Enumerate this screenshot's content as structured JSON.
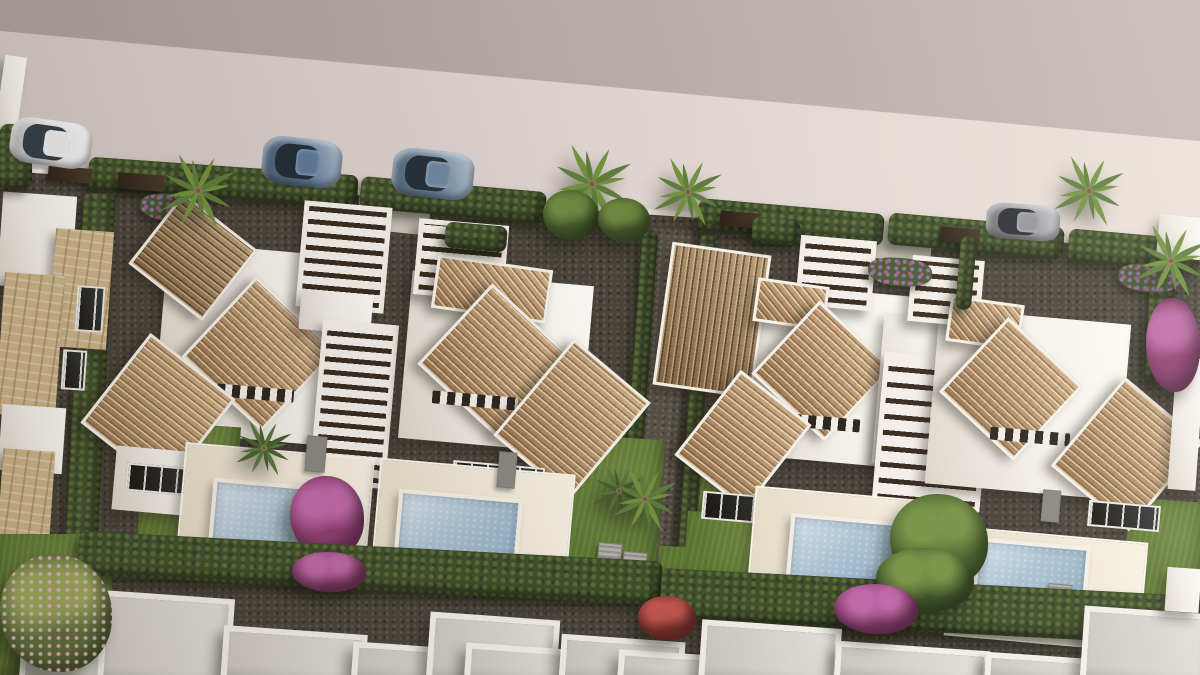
{
  "meta": {
    "scene_type": "3D aerial architectural rendering of a residential villa development",
    "view": "top-down bird's-eye, street with parked cars at top, two blocks of twin villas with terracotta roofs, pergolas, lawns and private pools, hedge boundaries, second row of white flat roofs at bottom"
  },
  "palette": {
    "road": "#d8cdc9",
    "upper_wall": "#b2a7a4",
    "white_walls": "#f2eee8",
    "roof_tile": "#bd9466",
    "roof_tile_dark": "#9b7a50",
    "pergola_slat": "#382c20",
    "hedge": "#42502c",
    "lawn": "#5e7833",
    "gravel": "#4a443c",
    "pool_water": "#abc2d3",
    "terrace": "#ece3d2",
    "stone": "#ccb488",
    "bougainvillea": "#8d3f72",
    "car_blue": "#5f7b99",
    "car_white": "#ebebec",
    "car_gray": "#94939a"
  },
  "objects": [
    {
      "n": "upper-wall-band",
      "t": "flat",
      "f": "linear-gradient(90deg,#aba09e,#c2b7b4)",
      "c": "polygon(0% 0%,100% 0%,100% 21%,0% 4.6%)"
    },
    {
      "n": "road",
      "t": "flat",
      "f": "linear-gradient(90deg,#d3c8c4,#eae0db)",
      "c": "polygon(0% 4.6%,100% 20.9%,100% 37.6%,0% 25.3%)"
    },
    {
      "n": "curb-line",
      "t": "flat",
      "f": "#f1e9e3",
      "c": "polygon(0% 24.7%,100% 36.3%,100% 37.6%,0% 25.6%)"
    },
    {
      "n": "ground-gravel",
      "t": "gravel",
      "c": "polygon(0% 25.3%,100% 37.3%,100% 100%,0% 100%)"
    },
    {
      "n": "driveway-left",
      "t": "flat",
      "x": 358,
      "y": 194,
      "w": 72,
      "h": 38,
      "r": 6,
      "f": "#c8c0b7"
    },
    {
      "n": "driveway-right",
      "t": "flat",
      "x": 858,
      "y": 222,
      "w": 74,
      "h": 38,
      "r": 6,
      "f": "#c8c0b7"
    },
    {
      "n": "center-path",
      "t": "gravel2",
      "x": 640,
      "y": 228,
      "w": 46,
      "h": 370,
      "r": 4
    },
    {
      "n": "front-hedge-1",
      "t": "hedge",
      "x": 88,
      "y": 166,
      "w": 270,
      "h": 32,
      "r": 4
    },
    {
      "n": "front-hedge-2",
      "t": "hedge",
      "x": 360,
      "y": 184,
      "w": 186,
      "h": 32,
      "r": 5
    },
    {
      "n": "front-hedge-3",
      "t": "hedge",
      "x": 698,
      "y": 206,
      "w": 186,
      "h": 32,
      "r": 5
    },
    {
      "n": "front-hedge-4",
      "t": "hedge",
      "x": 888,
      "y": 220,
      "w": 176,
      "h": 32,
      "r": 5
    },
    {
      "n": "front-hedge-5",
      "t": "hedge",
      "x": 1068,
      "y": 234,
      "w": 132,
      "h": 32,
      "r": 5
    },
    {
      "n": "gate-1",
      "t": "gate",
      "x": 48,
      "y": 167,
      "w": 44,
      "h": 15,
      "r": 5
    },
    {
      "n": "gate-2",
      "t": "gate",
      "x": 118,
      "y": 174,
      "w": 46,
      "h": 16,
      "r": 5
    },
    {
      "n": "gate-3",
      "t": "gate",
      "x": 720,
      "y": 212,
      "w": 40,
      "h": 15,
      "r": 5
    },
    {
      "n": "gate-4",
      "t": "gate",
      "x": 940,
      "y": 228,
      "w": 40,
      "h": 15,
      "r": 5
    },
    {
      "n": "left-boundary-hedge",
      "t": "hedge",
      "x": 74,
      "y": 193,
      "w": 32,
      "h": 374,
      "r": 3
    },
    {
      "n": "center-hedge-west",
      "t": "hedge",
      "x": 630,
      "y": 230,
      "w": 16,
      "h": 356,
      "r": 4
    },
    {
      "n": "center-hedge-east",
      "t": "hedge",
      "x": 688,
      "y": 234,
      "w": 16,
      "h": 356,
      "r": 4
    },
    {
      "n": "right-boundary-hedge",
      "t": "hedge",
      "x": 1148,
      "y": 250,
      "w": 26,
      "h": 132,
      "r": 3
    },
    {
      "n": "lawn-strip-right",
      "t": "lawn",
      "x": 658,
      "y": 554,
      "w": 320,
      "h": 38,
      "r": 3
    },
    {
      "n": "neighbor-left-roof",
      "t": "white",
      "x": 0,
      "y": 194,
      "w": 74,
      "h": 94,
      "r": 4
    },
    {
      "n": "neighbor-left-stone-a",
      "t": "stone",
      "x": 52,
      "y": 230,
      "w": 58,
      "h": 118,
      "r": 4
    },
    {
      "n": "neighbor-left-window-1",
      "t": "window",
      "x": 76,
      "y": 286,
      "w": 24,
      "h": 42,
      "r": 4
    },
    {
      "n": "neighbor-left-window-2",
      "t": "window",
      "x": 62,
      "y": 350,
      "w": 20,
      "h": 36,
      "r": 4
    },
    {
      "n": "neighbor-left-stone-b",
      "t": "stone",
      "x": 0,
      "y": 274,
      "w": 60,
      "h": 142,
      "r": 4
    },
    {
      "n": "neighbor-left-wall",
      "t": "white",
      "x": 0,
      "y": 406,
      "w": 64,
      "h": 66,
      "r": 4
    },
    {
      "n": "neighbor-left-stone-c",
      "t": "stone",
      "x": 0,
      "y": 450,
      "w": 52,
      "h": 98,
      "r": 4
    },
    {
      "n": "corner-building",
      "t": "white",
      "x": 0,
      "y": 56,
      "w": 22,
      "h": 74,
      "r": 8
    },
    {
      "n": "corner-hedge",
      "t": "hedge",
      "x": 0,
      "y": 124,
      "w": 32,
      "h": 64
    },
    {
      "n": "planter-flowers-left",
      "t": "flower",
      "x": 140,
      "y": 194,
      "w": 72,
      "h": 28,
      "r": 4
    },
    {
      "n": "villaA-white-main",
      "t": "white",
      "x": 160,
      "y": 250,
      "w": 205,
      "h": 190,
      "r": 5
    },
    {
      "n": "villaA-lawn",
      "t": "lawn",
      "x": 140,
      "y": 424,
      "w": 96,
      "h": 146,
      "r": 4
    },
    {
      "n": "villaA-entry-roof",
      "t": "roof-dark",
      "x": 146,
      "y": 212,
      "w": 88,
      "h": 84,
      "r": 38,
      "a": 0
    },
    {
      "n": "villaA-roof-main",
      "t": "roof",
      "x": 204,
      "y": 299,
      "w": 104,
      "h": 104,
      "r": 43,
      "a": 0
    },
    {
      "n": "villaA-vent-row",
      "t": "vent",
      "x": 202,
      "y": 386,
      "w": 92,
      "h": 13,
      "r": 5
    },
    {
      "n": "villaA-roof-low",
      "t": "roof",
      "x": 104,
      "y": 354,
      "w": 102,
      "h": 108,
      "r": 38,
      "a": 0
    },
    {
      "n": "villaA-wall-low",
      "t": "white",
      "x": 114,
      "y": 450,
      "w": 106,
      "h": 64,
      "r": 5
    },
    {
      "n": "villaA-window-band",
      "t": "window",
      "x": 126,
      "y": 466,
      "w": 76,
      "h": 24,
      "r": 5
    },
    {
      "n": "villaA-street-pergola",
      "t": "pergola",
      "x": 300,
      "y": 204,
      "w": 78,
      "h": 96,
      "r": 5,
      "a": 0
    },
    {
      "n": "villaA-walkway",
      "t": "white",
      "x": 300,
      "y": 292,
      "w": 72,
      "h": 40,
      "r": 5
    },
    {
      "n": "villaA-mid-pergola",
      "t": "pergola",
      "x": 316,
      "y": 322,
      "w": 66,
      "h": 154,
      "r": 5,
      "a": 0
    },
    {
      "n": "villaA-terrace",
      "t": "terrace",
      "x": 180,
      "y": 450,
      "w": 186,
      "h": 120,
      "r": 5
    },
    {
      "n": "villaA-pool",
      "t": "pool",
      "x": 210,
      "y": 484,
      "w": 140,
      "h": 74,
      "r": 5
    },
    {
      "n": "villaA-grill",
      "t": "ac",
      "x": 306,
      "y": 436,
      "w": 18,
      "h": 34,
      "r": 5,
      "f": "#8b8883"
    },
    {
      "n": "villaA-garden-palm",
      "t": "palm",
      "x": 228,
      "y": 412,
      "w": 72,
      "h": 72,
      "c1": "#47612f",
      "c2": "#5a7740"
    },
    {
      "n": "villaA-bougainvillea",
      "t": "tree",
      "x": 290,
      "y": 476,
      "w": 74,
      "h": 82,
      "c1": "#c06aa8",
      "c2": "#8d3f72"
    },
    {
      "n": "villaB-white-main",
      "t": "white",
      "x": 405,
      "y": 278,
      "w": 182,
      "h": 168,
      "r": 5
    },
    {
      "n": "villaB-lawn",
      "t": "lawn",
      "x": 540,
      "y": 436,
      "w": 120,
      "h": 148,
      "r": 4
    },
    {
      "n": "villaB-street-pergola",
      "t": "pergola",
      "x": 416,
      "y": 222,
      "w": 80,
      "h": 66,
      "r": 5,
      "a": 0
    },
    {
      "n": "villaB-roof-strip",
      "t": "roof",
      "x": 434,
      "y": 262,
      "w": 110,
      "h": 48,
      "r": 8,
      "a": 43
    },
    {
      "n": "villaB-roof-main",
      "t": "roof",
      "x": 440,
      "y": 306,
      "w": 104,
      "h": 104,
      "r": 43,
      "a": 0
    },
    {
      "n": "villaB-vent-row",
      "t": "vent",
      "x": 432,
      "y": 394,
      "w": 86,
      "h": 13,
      "r": 5
    },
    {
      "n": "villaB-roof-right",
      "t": "roof",
      "x": 522,
      "y": 356,
      "w": 94,
      "h": 120,
      "r": 40,
      "a": 0
    },
    {
      "n": "villaB-window-band",
      "t": "window",
      "x": 452,
      "y": 464,
      "w": 88,
      "h": 26,
      "r": 5
    },
    {
      "n": "villaB-terrace",
      "t": "terrace",
      "x": 375,
      "y": 466,
      "w": 192,
      "h": 114,
      "r": 5
    },
    {
      "n": "villaB-pool",
      "t": "pool",
      "x": 396,
      "y": 494,
      "w": 116,
      "h": 66,
      "r": 5
    },
    {
      "n": "villaB-grill",
      "t": "ac",
      "x": 498,
      "y": 452,
      "w": 16,
      "h": 34,
      "r": 5,
      "f": "#8b8883"
    },
    {
      "n": "villaB-garden-palm",
      "t": "palm",
      "x": 586,
      "y": 458,
      "w": 66,
      "h": 66,
      "c1": "#47612f",
      "c2": "#5a7740"
    },
    {
      "n": "villaB-ac-1",
      "t": "ac",
      "x": 598,
      "y": 543,
      "w": 22,
      "h": 14,
      "r": 5
    },
    {
      "n": "villaB-ac-2",
      "t": "ac",
      "x": 623,
      "y": 552,
      "w": 22,
      "h": 14,
      "r": 5
    },
    {
      "n": "center-palm",
      "t": "palm",
      "x": 604,
      "y": 458,
      "w": 82,
      "h": 82
    },
    {
      "n": "villaC-white-main",
      "t": "white",
      "x": 742,
      "y": 290,
      "w": 182,
      "h": 172,
      "r": 5
    },
    {
      "n": "villaC-lawn-upper",
      "t": "lawn",
      "x": 700,
      "y": 458,
      "w": 66,
      "h": 56,
      "r": 4
    },
    {
      "n": "villaC-lawn",
      "t": "lawn",
      "x": 685,
      "y": 514,
      "w": 94,
      "h": 82,
      "r": 4
    },
    {
      "n": "villaC-entry-roof",
      "t": "roof-dark",
      "x": 662,
      "y": 248,
      "w": 94,
      "h": 138,
      "r": 8,
      "a": 90
    },
    {
      "n": "villaC-street-pergola",
      "t": "pergola",
      "x": 798,
      "y": 238,
      "w": 66,
      "h": 60,
      "r": 5,
      "a": 0
    },
    {
      "n": "villaC-roof-strip",
      "t": "roof",
      "x": 755,
      "y": 282,
      "w": 66,
      "h": 38,
      "r": 8,
      "a": 43
    },
    {
      "n": "villaC-roof-main",
      "t": "roof",
      "x": 772,
      "y": 321,
      "w": 94,
      "h": 94,
      "r": 43,
      "a": 0
    },
    {
      "n": "villaC-vent-row",
      "t": "vent",
      "x": 778,
      "y": 416,
      "w": 82,
      "h": 13,
      "r": 5
    },
    {
      "n": "villaC-roof-low",
      "t": "roof",
      "x": 698,
      "y": 386,
      "w": 84,
      "h": 102,
      "r": 38,
      "a": 0
    },
    {
      "n": "villaC-white-east",
      "t": "white",
      "x": 878,
      "y": 316,
      "w": 102,
      "h": 152,
      "r": 5
    },
    {
      "n": "pergola-CD",
      "t": "pergola",
      "x": 878,
      "y": 356,
      "w": 98,
      "h": 142,
      "r": 5,
      "a": 0,
      "g": 16
    },
    {
      "n": "villaC-window-band",
      "t": "window",
      "x": 702,
      "y": 494,
      "w": 72,
      "h": 24,
      "r": 5
    },
    {
      "n": "villaC-terrace",
      "t": "terrace",
      "x": 750,
      "y": 494,
      "w": 196,
      "h": 120,
      "r": 5
    },
    {
      "n": "villaC-pool",
      "t": "pool",
      "x": 788,
      "y": 518,
      "w": 114,
      "h": 68,
      "r": 5
    },
    {
      "n": "villaD-white-main",
      "t": "white",
      "x": 932,
      "y": 316,
      "w": 192,
      "h": 176,
      "r": 5
    },
    {
      "n": "villaD-lawn",
      "t": "lawn",
      "x": 1125,
      "y": 500,
      "w": 78,
      "h": 120,
      "r": 4
    },
    {
      "n": "villaD-street-pergola",
      "t": "pergola",
      "x": 910,
      "y": 258,
      "w": 62,
      "h": 56,
      "r": 5,
      "a": 0
    },
    {
      "n": "villaD-roof-strip",
      "t": "roof",
      "x": 948,
      "y": 300,
      "w": 68,
      "h": 40,
      "r": 8,
      "a": 43
    },
    {
      "n": "villaD-roof-main",
      "t": "roof",
      "x": 960,
      "y": 338,
      "w": 96,
      "h": 96,
      "r": 43,
      "a": 0
    },
    {
      "n": "villaD-vent-row",
      "t": "vent",
      "x": 990,
      "y": 430,
      "w": 80,
      "h": 13,
      "r": 5
    },
    {
      "n": "villaD-roof-right",
      "t": "roof",
      "x": 1076,
      "y": 396,
      "w": 96,
      "h": 110,
      "r": 40,
      "a": 0
    },
    {
      "n": "villaD-window-band",
      "t": "window",
      "x": 1088,
      "y": 503,
      "w": 68,
      "h": 22,
      "r": 5
    },
    {
      "n": "villaD-terrace",
      "t": "terrace",
      "x": 948,
      "y": 534,
      "w": 192,
      "h": 106,
      "r": 5
    },
    {
      "n": "villaD-pool",
      "t": "pool",
      "x": 974,
      "y": 542,
      "w": 106,
      "h": 62,
      "r": 5
    },
    {
      "n": "villaD-grill",
      "t": "ac",
      "x": 1042,
      "y": 490,
      "w": 16,
      "h": 30,
      "r": 5,
      "f": "#8b8883"
    },
    {
      "n": "villaD-ac-1",
      "t": "ac",
      "x": 1048,
      "y": 584,
      "w": 22,
      "h": 14,
      "r": 5
    },
    {
      "n": "villaD-ac-2",
      "t": "ac",
      "x": 1072,
      "y": 593,
      "w": 22,
      "h": 14,
      "r": 5
    },
    {
      "n": "villaC-garden-tree",
      "t": "tree",
      "x": 890,
      "y": 494,
      "w": 98,
      "h": 94,
      "c1": "#7a9449",
      "c2": "#4d6530"
    },
    {
      "n": "neighbor-right-wall",
      "t": "white",
      "x": 1158,
      "y": 216,
      "w": 44,
      "h": 42,
      "r": 6
    },
    {
      "n": "neighbor-right-building",
      "t": "white",
      "x": 1172,
      "y": 358,
      "w": 28,
      "h": 132,
      "r": 4
    },
    {
      "n": "bougainvillea-right",
      "t": "tree",
      "x": 1146,
      "y": 298,
      "w": 54,
      "h": 94,
      "c1": "#c06aa8",
      "c2": "#8d3f72"
    },
    {
      "n": "front-bush-1",
      "t": "hedge",
      "x": 752,
      "y": 218,
      "w": 48,
      "h": 26,
      "r": 4
    },
    {
      "n": "front-bush-2",
      "t": "hedge",
      "x": 445,
      "y": 224,
      "w": 62,
      "h": 26,
      "r": 5
    },
    {
      "n": "cypress-D",
      "t": "hedge",
      "x": 958,
      "y": 236,
      "w": 16,
      "h": 74,
      "r": 5
    },
    {
      "n": "flower-front-C",
      "t": "flower",
      "x": 868,
      "y": 258,
      "w": 64,
      "h": 28,
      "r": 4
    },
    {
      "n": "flower-front-D",
      "t": "flower",
      "x": 1118,
      "y": 264,
      "w": 62,
      "h": 28,
      "r": 4
    },
    {
      "n": "lawn-bottom-left",
      "t": "lawn",
      "x": 0,
      "y": 534,
      "w": 112,
      "h": 141
    },
    {
      "n": "bottom-hedge-left",
      "t": "hedge",
      "x": 78,
      "y": 546,
      "w": 584,
      "h": 44,
      "r": 3
    },
    {
      "n": "bottom-hedge-right",
      "t": "hedge",
      "x": 660,
      "y": 582,
      "w": 540,
      "h": 50,
      "r": 3
    },
    {
      "n": "bottom-roof-1",
      "t": "roofbox",
      "x": 82,
      "y": 594,
      "w": 138,
      "h": 81,
      "r": 4
    },
    {
      "n": "bottom-roof-2",
      "t": "roofbox",
      "x": 20,
      "y": 644,
      "w": 72,
      "h": 31,
      "r": 4
    },
    {
      "n": "bottom-roof-3",
      "t": "roofbox",
      "x": 222,
      "y": 630,
      "w": 132,
      "h": 45,
      "r": 4
    },
    {
      "n": "bottom-roof-4",
      "t": "roofbox",
      "x": 352,
      "y": 646,
      "w": 122,
      "h": 29,
      "r": 4
    },
    {
      "n": "bottom-roof-5",
      "t": "roofbox",
      "x": 428,
      "y": 616,
      "w": 118,
      "h": 59,
      "r": 4
    },
    {
      "n": "bottom-roof-6",
      "t": "roofbox",
      "x": 465,
      "y": 646,
      "w": 92,
      "h": 29,
      "r": 4
    },
    {
      "n": "bottom-roof-7",
      "t": "roofbox",
      "x": 560,
      "y": 638,
      "w": 112,
      "h": 37,
      "r": 4
    },
    {
      "n": "bottom-roof-8",
      "t": "roofbox",
      "x": 618,
      "y": 653,
      "w": 102,
      "h": 22,
      "r": 4
    },
    {
      "n": "bottom-roof-9",
      "t": "roofbox",
      "x": 700,
      "y": 624,
      "w": 128,
      "h": 51,
      "r": 4
    },
    {
      "n": "bottom-roof-10",
      "t": "roofbox",
      "x": 835,
      "y": 646,
      "w": 142,
      "h": 29,
      "r": 4
    },
    {
      "n": "bottom-roof-11",
      "t": "roofbox",
      "x": 985,
      "y": 656,
      "w": 112,
      "h": 19,
      "r": 4
    },
    {
      "n": "bottom-roof-12",
      "t": "roofbox",
      "x": 1082,
      "y": 610,
      "w": 120,
      "h": 65,
      "r": 4
    },
    {
      "n": "bottom-white-shed",
      "t": "white",
      "x": 1166,
      "y": 568,
      "w": 34,
      "h": 44,
      "r": 4
    },
    {
      "n": "bougainvillea-bottom-1",
      "t": "tree",
      "x": 292,
      "y": 552,
      "w": 74,
      "h": 40,
      "c1": "#c06aa8",
      "c2": "#8d3f72"
    },
    {
      "n": "red-plants-bottom",
      "t": "tree",
      "x": 638,
      "y": 596,
      "w": 58,
      "h": 44,
      "c1": "#c2564f",
      "c2": "#8a3732"
    },
    {
      "n": "tree-bottom-green",
      "t": "tree",
      "x": 876,
      "y": 548,
      "w": 98,
      "h": 64,
      "c1": "#7a9449",
      "c2": "#44592c"
    },
    {
      "n": "bougainvillea-bottom-2",
      "t": "tree",
      "x": 834,
      "y": 584,
      "w": 84,
      "h": 50,
      "c1": "#c06aa8",
      "c2": "#8d3f72"
    },
    {
      "n": "pink-tree-left",
      "t": "tree",
      "x": 0,
      "y": 554,
      "w": 112,
      "h": 118,
      "c1": "#9aa85e",
      "c2": "#5e6c3c",
      "d": "#e3b8c4"
    },
    {
      "n": "street-palm-1",
      "t": "palm",
      "x": 150,
      "y": 143,
      "w": 96,
      "h": 96
    },
    {
      "n": "street-palm-2",
      "t": "palm",
      "x": 541,
      "y": 133,
      "w": 102,
      "h": 102
    },
    {
      "n": "street-palm-3",
      "t": "palm",
      "x": 644,
      "y": 148,
      "w": 88,
      "h": 88
    },
    {
      "n": "street-palm-4",
      "t": "palm",
      "x": 1044,
      "y": 146,
      "w": 90,
      "h": 90
    },
    {
      "n": "street-palm-5",
      "t": "palm",
      "x": 1125,
      "y": 215,
      "w": 92,
      "h": 92
    },
    {
      "n": "street-tree-1",
      "t": "tree",
      "x": 543,
      "y": 190,
      "w": 56,
      "h": 50,
      "c1": "#6d8a42",
      "c2": "#4c6230"
    },
    {
      "n": "street-tree-2",
      "t": "tree",
      "x": 598,
      "y": 198,
      "w": 52,
      "h": 44,
      "c1": "#6d8a42",
      "c2": "#4c6230"
    },
    {
      "n": "car-white-hatchback",
      "t": "car",
      "x": 10,
      "y": 120,
      "w": 82,
      "h": 46,
      "r": 8,
      "f": "#ebebec",
      "gl": "#343f47"
    },
    {
      "n": "car-blue-suv-1",
      "t": "car",
      "x": 262,
      "y": 138,
      "w": 80,
      "h": 48,
      "r": 6,
      "f": "#5f7b99",
      "gl": "#242e38"
    },
    {
      "n": "car-blue-suv-2",
      "t": "car",
      "x": 392,
      "y": 150,
      "w": 82,
      "h": 48,
      "r": 6,
      "f": "#6e88a0",
      "gl": "#273039"
    },
    {
      "n": "car-gray-sedan",
      "t": "car",
      "x": 986,
      "y": 204,
      "w": 74,
      "h": 36,
      "r": 4,
      "f": "#94939a",
      "gl": "#2b3036"
    },
    {
      "n": "sunlight-overlay",
      "t": "flat",
      "f": "linear-gradient(245deg,rgba(255,250,233,.16),rgba(255,255,255,0) 38%,rgba(45,33,22,.12) 96%)"
    }
  ]
}
